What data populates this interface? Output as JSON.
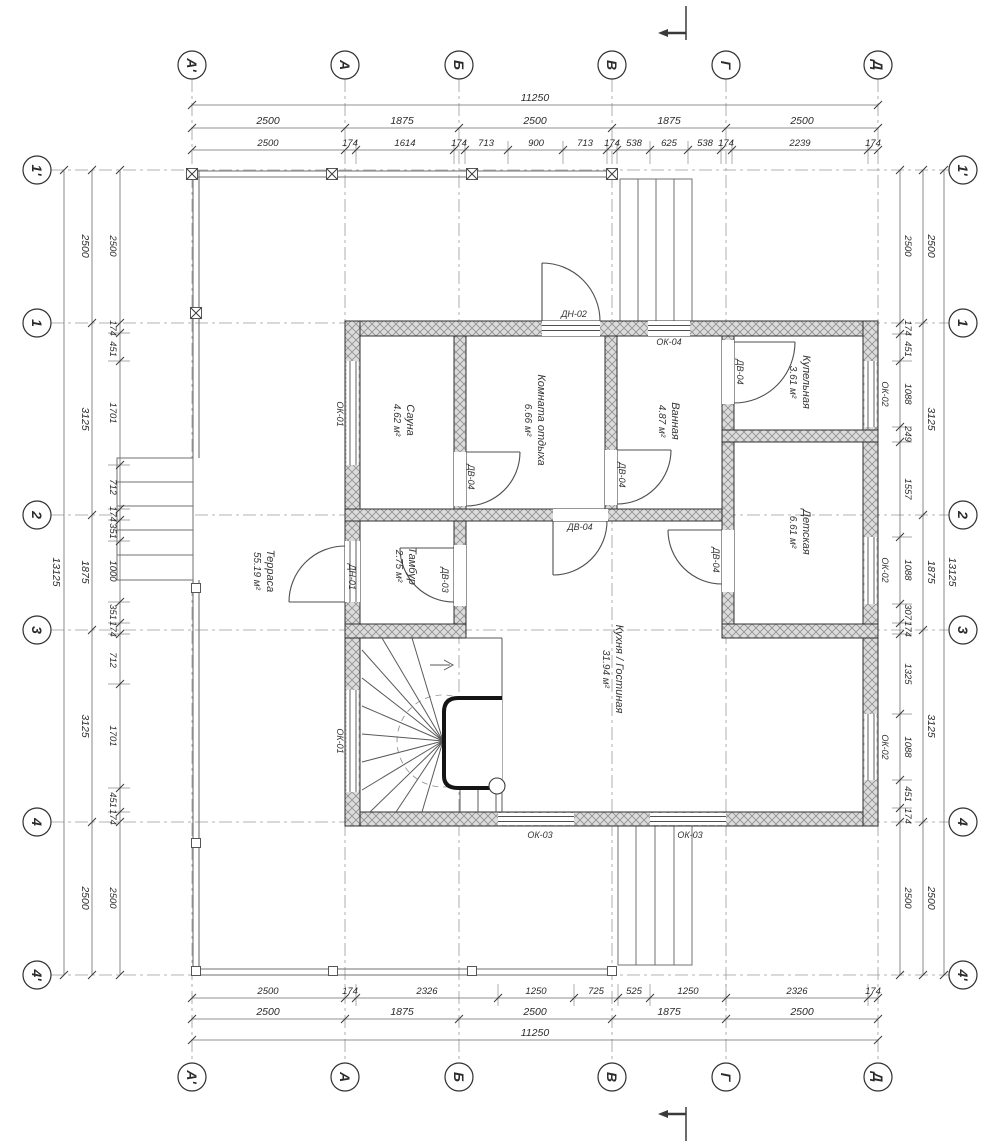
{
  "drawing": {
    "type": "floor-plan"
  },
  "colors": {
    "line": "#3a3a3a",
    "axis_line": "#9a9a9a",
    "wall_hatch_bg": "#dcdcdc",
    "wall_hatch_line": "#8f8f8f",
    "text": "#2b2b2b"
  },
  "axes": {
    "cols": [
      "А'",
      "А",
      "Б",
      "В",
      "Г",
      "Д"
    ],
    "rows": [
      "1'",
      "1",
      "2",
      "3",
      "4",
      "4'"
    ]
  },
  "dims": {
    "top_total": "11250",
    "bottom_total": "11250",
    "left_total": "13125",
    "right_total": "13125",
    "top_mid": [
      "2500",
      "1875",
      "2500",
      "1875",
      "2500"
    ],
    "bottom_mid": [
      "2500",
      "1875",
      "2500",
      "1875",
      "2500"
    ],
    "left_mid": [
      "2500",
      "3125",
      "1875",
      "3125",
      "2500"
    ],
    "right_mid": [
      "2500",
      "3125",
      "1875",
      "3125",
      "2500"
    ],
    "top_detail": [
      "2500",
      "174",
      "1614",
      "174",
      "713",
      "900",
      "713",
      "174",
      "538",
      "625",
      "538",
      "174",
      "2239",
      "174"
    ],
    "bottom_detail": [
      "2500",
      "174",
      "2326",
      "1250",
      "725",
      "525",
      "1250",
      "2326",
      "174"
    ],
    "left_detail": [
      "2500",
      "174",
      "451",
      "1701",
      "712",
      "174",
      "351",
      "1000",
      "351",
      "174",
      "712",
      "1701",
      "451",
      "174",
      "2500"
    ],
    "right_detail": [
      "2500",
      "174",
      "451",
      "1088",
      "249",
      "1557",
      "1088",
      "307",
      "174",
      "1325",
      "1088",
      "451",
      "174",
      "2500"
    ]
  },
  "rooms": [
    {
      "name": "Сауна",
      "area": "4.62 м²"
    },
    {
      "name": "Комната отдыха",
      "area": "6.66 м²"
    },
    {
      "name": "Ванная",
      "area": "4.87 м²"
    },
    {
      "name": "Купельная",
      "area": "3.61 м²"
    },
    {
      "name": "Детская",
      "area": "6.61 м²"
    },
    {
      "name": "Кухня / Гостиная",
      "area": "31.94 м²"
    },
    {
      "name": "Тамбур",
      "area": "2.75 м²"
    },
    {
      "name": "Терраса",
      "area": "55.19 м²"
    }
  ],
  "tags": {
    "ok01": "ОК-01",
    "ok02": "ОК-02",
    "ok03": "ОК-03",
    "ok04": "ОК-04",
    "dv03": "ДВ-03",
    "dv04": "ДВ-04",
    "dn01": "ДН-01",
    "dn02": "ДН-02"
  }
}
